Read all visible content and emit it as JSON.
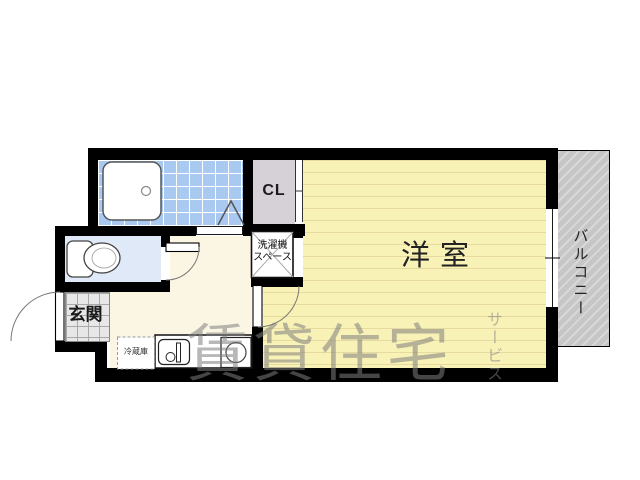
{
  "floorplan": {
    "labels": {
      "western_room": "洋室",
      "closet": "CL",
      "balcony": "バルコニー",
      "entrance": "玄関",
      "washer_space_line1": "洗濯機",
      "washer_space_line2": "スペース",
      "refrigerator": "冷蔵庫"
    },
    "watermark": {
      "main": "賃貸住宅",
      "sub": "サービス"
    },
    "colors": {
      "wall": "#000000",
      "western_room_fill": "#f8f2b6",
      "western_room_stripe": "#e6daa0",
      "bathroom_tile": "#a9c9f1",
      "toilet_fill": "#dfe9f7",
      "closet_fill": "#d6d1d7",
      "balcony_fill": "#c6c6c6",
      "kitchen_fill": "#faf6e3",
      "entrance_tile": "#e7e7e7",
      "watermark": "#7d7d7d"
    }
  }
}
